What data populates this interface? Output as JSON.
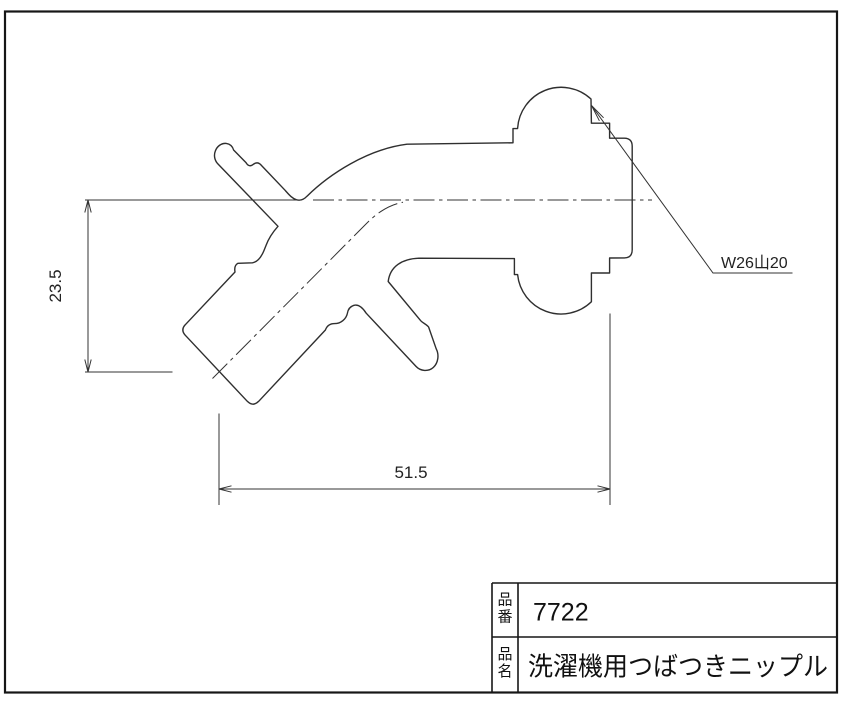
{
  "dimensions": {
    "height": "23.5",
    "width": "51.5"
  },
  "thread": {
    "label": "W26山20"
  },
  "title_block": {
    "part_number_label_top": "品",
    "part_number_label_bottom": "番",
    "part_number": "7722",
    "part_name_label_top": "品",
    "part_name_label_bottom": "名",
    "part_name": "洗濯機用つばつきニップル"
  },
  "colors": {
    "line": "#2f2f2f",
    "frame": "#161616",
    "background": "#ffffff"
  }
}
